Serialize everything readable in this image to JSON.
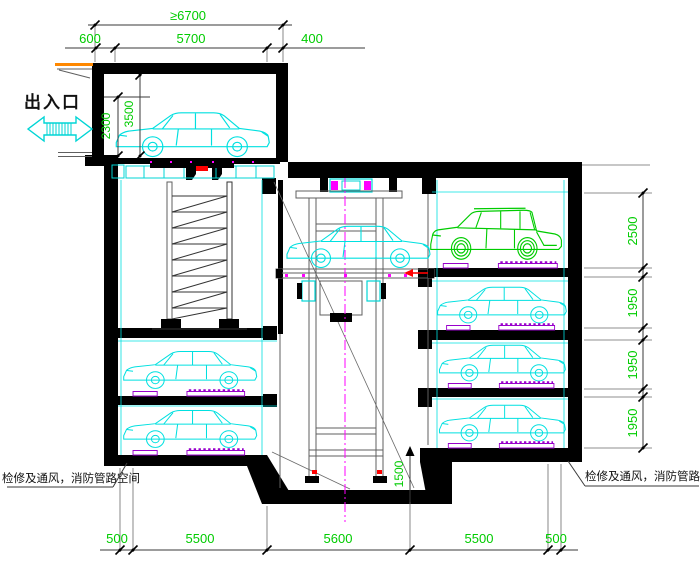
{
  "labels": {
    "entrance": "出入口",
    "service_space_left": "检修及通风，消防管路空间",
    "service_space_right": "检修及通风，消防管路空间"
  },
  "dimensions": {
    "top": {
      "overall": "≥6700",
      "left_overhang": "600",
      "opening": "5700",
      "right_offset": "400"
    },
    "entrance": {
      "door_height": "2300",
      "hall_height": "3500"
    },
    "right_levels": [
      "2500",
      "1950",
      "1950",
      "1950"
    ],
    "pit_depth": "1500",
    "bottom": [
      "500",
      "5500",
      "5600",
      "5500",
      "500"
    ]
  },
  "colors": {
    "dimension_text": "#00cc00",
    "car_outline": "#00e0e0",
    "suv_outline": "#00cc00",
    "pallet": "#9900cc",
    "centerline": "#ff00ff",
    "canopy": "#ff8800",
    "structure": "#000000",
    "accent_red": "#ff0000"
  },
  "icons": {
    "entrance_arrow": "two-way-arrow-icon"
  }
}
